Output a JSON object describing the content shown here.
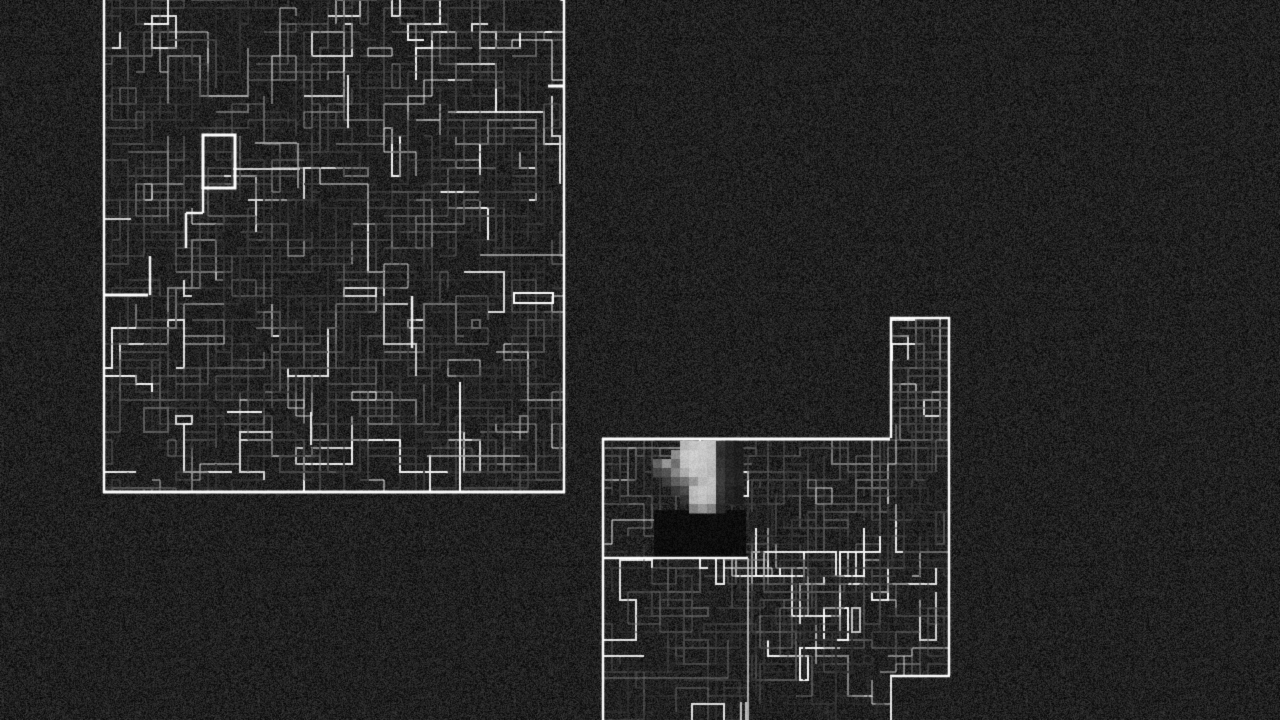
{
  "scene": {
    "width": 1280,
    "height": 720,
    "background": "#000000",
    "noise": {
      "tile": 256,
      "seed_a": 11,
      "seed_b": 23,
      "base_alpha": 0.15,
      "overlay_alpha": 0.09,
      "salt_prob": 0.02
    },
    "palette": {
      "border": "#ffffff",
      "line_bright": "#f0f0f0",
      "line_dim": "#555555",
      "blob_light": "#bcbcbc",
      "blob_dark": "#2a2a2a",
      "void": "#010101"
    }
  },
  "regions": {
    "upper_left_map": {
      "label": "upper-left explored maze map",
      "clip": [
        [
          104,
          -24
        ],
        [
          564,
          -24
        ],
        [
          564,
          493
        ],
        [
          104,
          493
        ]
      ],
      "border_segments": [
        [
          104,
          -20,
          104,
          493,
          2.5,
          255
        ],
        [
          564,
          -20,
          564,
          493,
          2.5,
          255
        ],
        [
          103,
          492,
          565,
          492,
          3,
          255
        ]
      ],
      "maze": [
        {
          "area": [
            104,
            -16,
            460,
            508
          ],
          "strokes": 640,
          "seed": 101,
          "bright": 0.1,
          "min": 35,
          "range": 125,
          "grid": 8
        }
      ],
      "highlight_rects": [
        [
          203,
          135,
          32,
          53,
          3,
          255
        ],
        [
          514,
          293,
          39,
          10,
          2,
          250
        ]
      ],
      "highlight_segments": [
        [
          104,
          295,
          148,
          295,
          3,
          255
        ],
        [
          150,
          256,
          150,
          295,
          2.5,
          235
        ],
        [
          203,
          187,
          203,
          213,
          2.5,
          245
        ],
        [
          203,
          213,
          186,
          213,
          2.5,
          245
        ],
        [
          186,
          213,
          186,
          248,
          2.5,
          240
        ],
        [
          233,
          169,
          300,
          169,
          2,
          200
        ],
        [
          255,
          143,
          297,
          143,
          1.5,
          175
        ],
        [
          298,
          143,
          298,
          188,
          1.5,
          165
        ],
        [
          412,
          296,
          412,
          348,
          2.5,
          230
        ],
        [
          460,
          382,
          460,
          492,
          2,
          235
        ],
        [
          311,
          412,
          311,
          445,
          2,
          220
        ],
        [
          227,
          412,
          262,
          412,
          2,
          230
        ],
        [
          348,
          75,
          348,
          128,
          2,
          220
        ],
        [
          548,
          86,
          564,
          86,
          3,
          255
        ],
        [
          104,
          219,
          131,
          219,
          2,
          200
        ],
        [
          430,
          455,
          430,
          492,
          2,
          220
        ],
        [
          427,
          456,
          520,
          456,
          1.5,
          170
        ],
        [
          480,
          255,
          564,
          255,
          1.5,
          170
        ]
      ]
    },
    "lower_right_map": {
      "label": "lower-right explored maze map with player glow",
      "clip": [
        [
          603,
          438
        ],
        [
          890,
          438
        ],
        [
          890,
          317
        ],
        [
          949,
          317
        ],
        [
          949,
          677
        ],
        [
          890,
          677
        ],
        [
          890,
          726
        ],
        [
          603,
          726
        ]
      ],
      "border_segments": [
        [
          890,
          318,
          950,
          318,
          2.5,
          255
        ],
        [
          891,
          317,
          891,
          438,
          2.5,
          255
        ],
        [
          949,
          317,
          949,
          676,
          2.5,
          255
        ],
        [
          602,
          439,
          890,
          439,
          3,
          255
        ],
        [
          603,
          438,
          603,
          726,
          2.5,
          255
        ],
        [
          602,
          558,
          748,
          558,
          2.5,
          255
        ],
        [
          748,
          558,
          748,
          726,
          1.5,
          205
        ],
        [
          890,
          676,
          950,
          676,
          2.5,
          255
        ],
        [
          891,
          676,
          891,
          726,
          2,
          225
        ]
      ],
      "maze": [
        {
          "area": [
            892,
            320,
            56,
            116
          ],
          "strokes": 64,
          "seed": 202,
          "bright": 0.12,
          "min": 40,
          "range": 120,
          "grid": 8
        },
        {
          "area": [
            752,
            440,
            196,
            234
          ],
          "strokes": 150,
          "seed": 203,
          "bright": 0.1,
          "min": 35,
          "range": 115,
          "grid": 8
        },
        {
          "area": [
            604,
            560,
            284,
            164
          ],
          "strokes": 78,
          "seed": 204,
          "bright": 0.08,
          "min": 30,
          "range": 105,
          "grid": 8
        },
        {
          "area": [
            604,
            440,
            146,
            116
          ],
          "strokes": 60,
          "seed": 205,
          "bright": 0.1,
          "min": 35,
          "range": 115,
          "grid": 8
        }
      ],
      "highlight_rects": [],
      "highlight_segments": [
        [
          602,
          678,
          728,
          678,
          1,
          115
        ],
        [
          728,
          640,
          728,
          678,
          1,
          100
        ],
        [
          741,
          702,
          741,
          726,
          1.5,
          230
        ],
        [
          746,
          702,
          746,
          726,
          1.5,
          230
        ]
      ],
      "black_patch": [
        654,
        510,
        92,
        48
      ],
      "blob": {
        "x": 653,
        "y": 441,
        "cell": 9,
        "rows": [
          [
            0,
            0,
            0,
            170,
            182,
            188,
            180,
            40,
            24,
            18
          ],
          [
            0,
            0,
            130,
            185,
            192,
            188,
            182,
            36,
            24,
            18
          ],
          [
            88,
            138,
            100,
            180,
            190,
            186,
            176,
            40,
            24,
            18
          ],
          [
            58,
            72,
            122,
            160,
            185,
            180,
            170,
            46,
            26,
            20
          ],
          [
            0,
            50,
            82,
            102,
            140,
            172,
            180,
            50,
            30,
            24
          ],
          [
            0,
            0,
            46,
            62,
            176,
            186,
            180,
            44,
            24,
            18
          ],
          [
            0,
            0,
            0,
            40,
            170,
            180,
            170,
            38,
            20,
            16
          ],
          [
            0,
            0,
            0,
            0,
            118,
            140,
            118,
            28,
            0,
            0
          ]
        ]
      }
    }
  }
}
